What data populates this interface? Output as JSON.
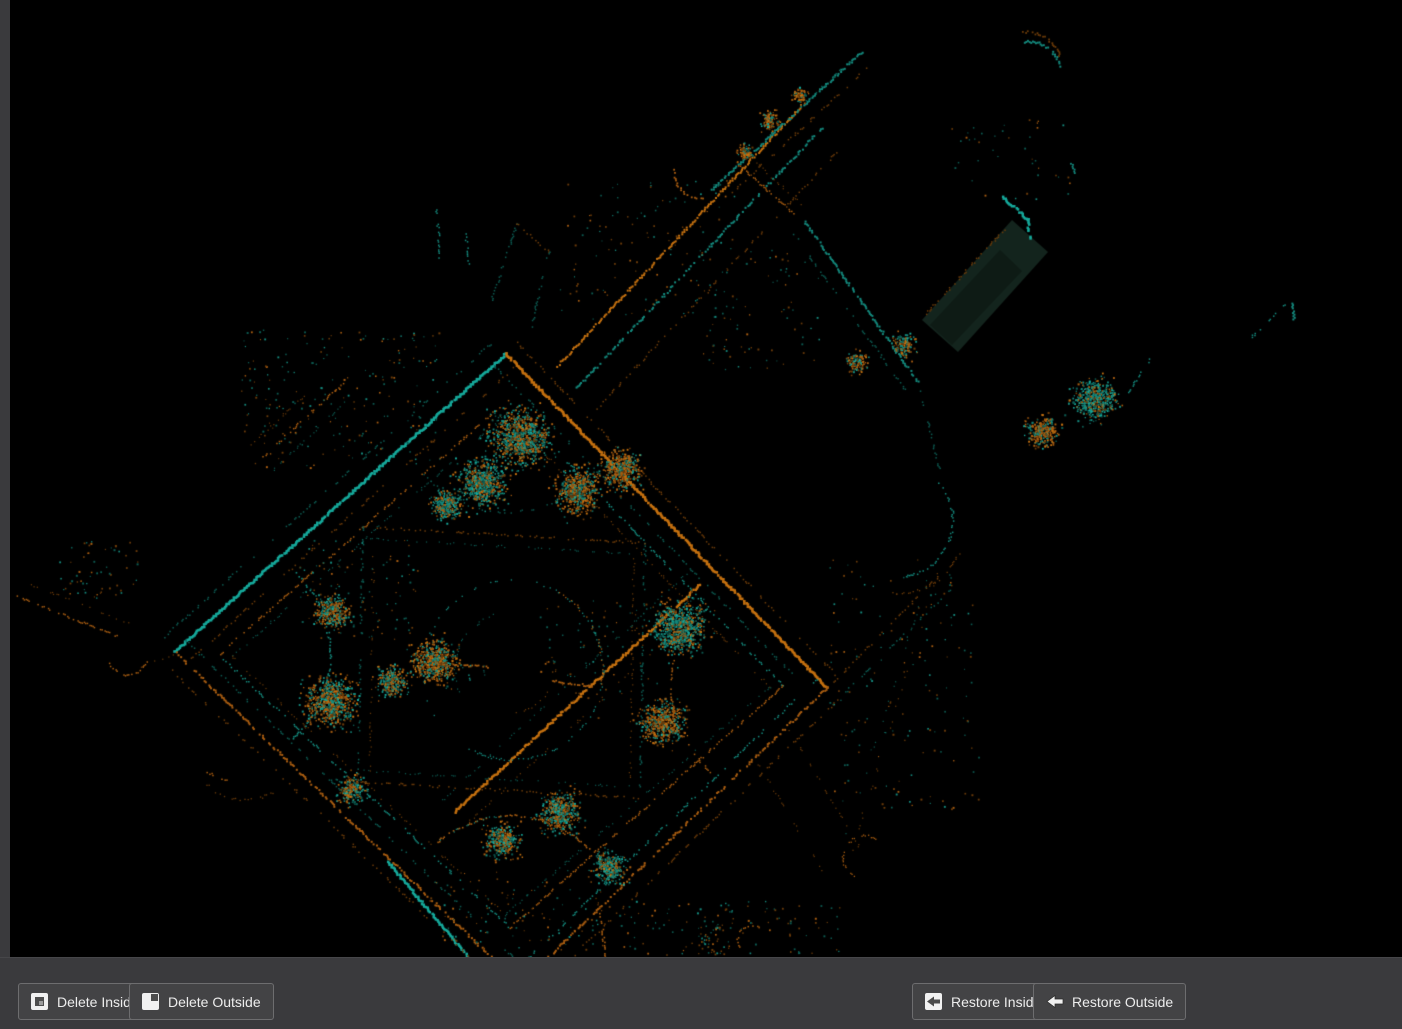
{
  "frame": {
    "bg": "#3a3a3d",
    "viewport_bg": "#000000"
  },
  "toolbar": {
    "buttons": [
      {
        "id": "delete-inside",
        "label": "Delete Inside",
        "icon": "delete-inside-icon"
      },
      {
        "id": "delete-outside",
        "label": "Delete Outside",
        "icon": "delete-outside-icon"
      },
      {
        "id": "restore-inside",
        "label": "Restore Inside",
        "icon": "restore-inside-icon"
      },
      {
        "id": "restore-outside",
        "label": "Restore Outside",
        "icon": "restore-outside-icon"
      }
    ]
  },
  "palette": {
    "tealBright": "#15a89a",
    "teal": "#13887c",
    "tealDim": "#0b5a51",
    "orangeBright": "#c4700f",
    "orange": "#a85c10",
    "orangeDim": "#6b3a08"
  },
  "scene": {
    "seed": 1337,
    "polys": [
      {
        "pts": [
          [
            1012,
            220
          ],
          [
            1048,
            252
          ],
          [
            958,
            352
          ],
          [
            922,
            320
          ]
        ],
        "fill": "#13241d"
      },
      {
        "pts": [
          [
            1000,
            250
          ],
          [
            1022,
            271
          ],
          [
            952,
            345
          ],
          [
            930,
            325
          ]
        ],
        "fill": "#0e1b15"
      }
    ],
    "lines": [
      [
        175,
        652,
        506,
        354,
        "tealBright",
        2.6,
        0.97
      ],
      [
        163,
        638,
        494,
        341,
        "tealDim",
        1.5,
        0.3
      ],
      [
        186,
        664,
        515,
        367,
        "orangeDim",
        1.5,
        0.25
      ],
      [
        506,
        354,
        827,
        688,
        "orangeBright",
        2.6,
        0.95
      ],
      [
        517,
        343,
        838,
        677,
        "orangeDim",
        1.5,
        0.35
      ],
      [
        495,
        366,
        816,
        699,
        "tealDim",
        1.5,
        0.25
      ],
      [
        827,
        688,
        520,
        985,
        "orange",
        2,
        0.55
      ],
      [
        819,
        677,
        512,
        974,
        "teal",
        1.5,
        0.35
      ],
      [
        839,
        699,
        532,
        996,
        "orangeDim",
        1.5,
        0.3
      ],
      [
        175,
        652,
        520,
        985,
        "orange",
        2,
        0.6
      ],
      [
        186,
        641,
        531,
        974,
        "tealDim",
        1.5,
        0.3
      ],
      [
        388,
        862,
        468,
        957,
        "tealBright",
        2.5,
        0.95
      ],
      [
        164,
        663,
        509,
        996,
        "orangeDim",
        1.5,
        0.25
      ],
      [
        219,
        655,
        508,
        400,
        "orange",
        1.5,
        0.45
      ],
      [
        508,
        400,
        783,
        686,
        "teal",
        1.5,
        0.4
      ],
      [
        783,
        686,
        510,
        928,
        "orange",
        1.5,
        0.45
      ],
      [
        219,
        655,
        510,
        928,
        "teal",
        1.5,
        0.4
      ],
      [
        232,
        657,
        506,
        414,
        "tealDim",
        1.2,
        0.3
      ],
      [
        506,
        414,
        770,
        687,
        "orangeDim",
        1.2,
        0.3
      ],
      [
        770,
        687,
        505,
        915,
        "tealDim",
        1.2,
        0.3
      ],
      [
        232,
        657,
        505,
        915,
        "orangeDim",
        1.2,
        0.3
      ],
      [
        363,
        527,
        645,
        543,
        "orangeDim",
        1.5,
        0.35
      ],
      [
        645,
        543,
        640,
        798,
        "tealDim",
        1.5,
        0.3
      ],
      [
        640,
        798,
        358,
        782,
        "orangeDim",
        1.5,
        0.35
      ],
      [
        358,
        782,
        363,
        527,
        "tealDim",
        1.5,
        0.3
      ],
      [
        369,
        539,
        639,
        554,
        "tealDim",
        1.2,
        0.25
      ],
      [
        634,
        554,
        630,
        787,
        "orangeDim",
        1.2,
        0.25
      ],
      [
        634,
        787,
        364,
        771,
        "tealDim",
        1.2,
        0.25
      ],
      [
        370,
        771,
        374,
        539,
        "orangeDim",
        1.2,
        0.25
      ],
      [
        700,
        585,
        455,
        812,
        "orangeBright",
        2.4,
        0.9
      ],
      [
        712,
        597,
        468,
        823,
        "orangeDim",
        1.2,
        0.25
      ],
      [
        688,
        573,
        443,
        800,
        "tealDim",
        1.2,
        0.2
      ],
      [
        428,
        664,
        488,
        667,
        "orange",
        1.8,
        0.85
      ],
      [
        553,
        681,
        592,
        686,
        "orange",
        1.8,
        0.8
      ],
      [
        470,
        664,
        470,
        680,
        "teal",
        1.5,
        0.7
      ],
      [
        484,
        666,
        484,
        678,
        "tealDim",
        1.2,
        0.5
      ],
      [
        556,
        368,
        800,
        108,
        "orangeBright",
        2,
        0.8
      ],
      [
        577,
        388,
        822,
        128,
        "teal",
        2,
        0.5
      ],
      [
        597,
        409,
        841,
        148,
        "orangeDim",
        1.5,
        0.3
      ],
      [
        862,
        52,
        712,
        190,
        "teal",
        2,
        0.85
      ],
      [
        874,
        62,
        724,
        200,
        "orangeDim",
        1.5,
        0.3
      ],
      [
        737,
        163,
        795,
        215,
        "orange",
        1.5,
        0.5
      ],
      [
        747,
        155,
        803,
        205,
        "orangeDim",
        1.2,
        0.3
      ],
      [
        805,
        222,
        918,
        382,
        "teal",
        2,
        0.8
      ],
      [
        793,
        233,
        907,
        392,
        "tealDim",
        1.5,
        0.35
      ],
      [
        918,
        382,
        940,
        470,
        "tealDim",
        1.5,
        0.3
      ],
      [
        925,
        315,
        1010,
        224,
        "orangeDim",
        1.5,
        0.45
      ],
      [
        1003,
        197,
        1028,
        220,
        "tealBright",
        2.5,
        0.9
      ],
      [
        1028,
        220,
        1030,
        240,
        "tealBright",
        2.5,
        0.9
      ],
      [
        834,
        682,
        938,
        577,
        "orangeDim",
        1.5,
        0.35
      ],
      [
        846,
        692,
        950,
        590,
        "tealDim",
        1.5,
        0.3
      ],
      [
        942,
        560,
        852,
        850,
        "orangeDim",
        1.2,
        0.15
      ],
      [
        930,
        572,
        845,
        840,
        "tealDim",
        1.2,
        0.1
      ],
      [
        790,
        730,
        862,
        852,
        "orangeDim",
        1.2,
        0.25
      ],
      [
        757,
        762,
        828,
        880,
        "orangeDim",
        1.2,
        0.2
      ],
      [
        492,
        300,
        517,
        224,
        "tealDim",
        1.5,
        0.45
      ],
      [
        517,
        224,
        549,
        252,
        "orangeDim",
        1.5,
        0.45
      ],
      [
        549,
        252,
        531,
        330,
        "tealDim",
        1.5,
        0.35
      ],
      [
        437,
        210,
        440,
        258,
        "teal",
        1.5,
        0.6
      ],
      [
        466,
        234,
        469,
        264,
        "teal",
        1.5,
        0.5
      ],
      [
        262,
        458,
        343,
        383,
        "orange",
        1.5,
        0.5
      ],
      [
        250,
        446,
        331,
        371,
        "orangeDim",
        1.2,
        0.3
      ],
      [
        274,
        470,
        352,
        396,
        "tealDim",
        1.2,
        0.25
      ],
      [
        17,
        597,
        120,
        637,
        "orange",
        1.5,
        0.5
      ],
      [
        30,
        584,
        130,
        624,
        "orangeDim",
        1.2,
        0.3
      ],
      [
        140,
        668,
        176,
        653,
        "orangeDim",
        1.2,
        0.3
      ],
      [
        1252,
        337,
        1285,
        305,
        "teal",
        1.5,
        0.5
      ],
      [
        1293,
        302,
        1294,
        321,
        "teal",
        2,
        0.8
      ],
      [
        1152,
        357,
        1128,
        392,
        "teal",
        1.5,
        0.5
      ],
      [
        1071,
        162,
        1075,
        173,
        "teal",
        1.8,
        0.8
      ],
      [
        203,
        770,
        231,
        783,
        "orange",
        1.5,
        0.5
      ],
      [
        600,
        912,
        606,
        957,
        "orange",
        1.6,
        0.5
      ],
      [
        596,
        895,
        602,
        914,
        "orangeDim",
        1.3,
        0.4
      ],
      [
        800,
        108,
        852,
        60,
        "tealDim",
        1.5,
        0.3
      ]
    ],
    "arcs": [
      [
        513,
        670,
        90,
        -30,
        120,
        "teal",
        1.3,
        0.4
      ],
      [
        513,
        670,
        90,
        150,
        330,
        "teal",
        1.3,
        0.25
      ],
      [
        513,
        670,
        90,
        -60,
        10,
        "orange",
        1.3,
        0.35
      ],
      [
        513,
        670,
        58,
        150,
        260,
        "tealDim",
        1.2,
        0.3
      ],
      [
        513,
        670,
        42,
        -20,
        90,
        "orangeDim",
        1.2,
        0.3
      ],
      [
        219,
        655,
        112,
        -50,
        50,
        "teal",
        1.6,
        0.5
      ],
      [
        508,
        400,
        112,
        40,
        140,
        "tealDim",
        1.4,
        0.35
      ],
      [
        783,
        686,
        112,
        130,
        230,
        "orange",
        1.5,
        0.4
      ],
      [
        510,
        928,
        112,
        -130,
        -30,
        "orange",
        1.6,
        0.55
      ],
      [
        510,
        928,
        112,
        -130,
        -30,
        "teal",
        1.2,
        0.25
      ],
      [
        895,
        520,
        58,
        -40,
        80,
        "teal",
        1.5,
        0.5
      ],
      [
        898,
        528,
        66,
        20,
        100,
        "orangeDim",
        1.3,
        0.35
      ],
      [
        1030,
        72,
        30,
        -100,
        -10,
        "teal",
        2,
        0.8
      ],
      [
        1026,
        68,
        36,
        -95,
        -20,
        "orangeDim",
        1.8,
        0.5
      ],
      [
        700,
        172,
        26,
        80,
        185,
        "orange",
        1.8,
        0.6
      ],
      [
        128,
        655,
        20,
        20,
        160,
        "orange",
        1.5,
        0.6
      ],
      [
        865,
        858,
        22,
        120,
        300,
        "orange",
        1.3,
        0.5
      ],
      [
        245,
        745,
        55,
        60,
        140,
        "orangeDim",
        1.3,
        0.3
      ],
      [
        752,
        940,
        14,
        150,
        300,
        "orange",
        1.5,
        0.6
      ]
    ],
    "blobs": [
      [
        520,
        438,
        36,
        900,
        0.5
      ],
      [
        483,
        482,
        30,
        650,
        0.65
      ],
      [
        447,
        505,
        20,
        300,
        0.6
      ],
      [
        577,
        492,
        28,
        550,
        0.35
      ],
      [
        621,
        470,
        26,
        450,
        0.3
      ],
      [
        435,
        662,
        28,
        550,
        0.35
      ],
      [
        392,
        682,
        20,
        280,
        0.5
      ],
      [
        331,
        702,
        32,
        700,
        0.45
      ],
      [
        333,
        612,
        22,
        350,
        0.4
      ],
      [
        680,
        628,
        34,
        750,
        0.7
      ],
      [
        663,
        723,
        28,
        520,
        0.35
      ],
      [
        560,
        812,
        26,
        450,
        0.5
      ],
      [
        502,
        842,
        22,
        350,
        0.55
      ],
      [
        610,
        868,
        20,
        300,
        0.65
      ],
      [
        352,
        790,
        18,
        220,
        0.5
      ],
      [
        1095,
        400,
        28,
        500,
        0.7
      ],
      [
        1042,
        432,
        20,
        280,
        0.35
      ],
      [
        770,
        120,
        12,
        120,
        0.25
      ],
      [
        745,
        152,
        10,
        90,
        0.3
      ],
      [
        800,
        96,
        10,
        80,
        0.25
      ],
      [
        905,
        345,
        16,
        150,
        0.5
      ],
      [
        858,
        362,
        14,
        120,
        0.3
      ]
    ],
    "speckles": [
      [
        240,
        330,
        200,
        140,
        220
      ],
      [
        560,
        180,
        180,
        140,
        120
      ],
      [
        830,
        560,
        150,
        250,
        160
      ],
      [
        300,
        540,
        120,
        100,
        100
      ],
      [
        540,
        600,
        140,
        120,
        90
      ],
      [
        620,
        900,
        220,
        56,
        120
      ],
      [
        60,
        540,
        80,
        60,
        60
      ],
      [
        950,
        120,
        120,
        80,
        40
      ],
      [
        430,
        870,
        180,
        80,
        100
      ],
      [
        700,
        250,
        120,
        120,
        80
      ],
      [
        695,
        925,
        30,
        30,
        40
      ]
    ]
  }
}
